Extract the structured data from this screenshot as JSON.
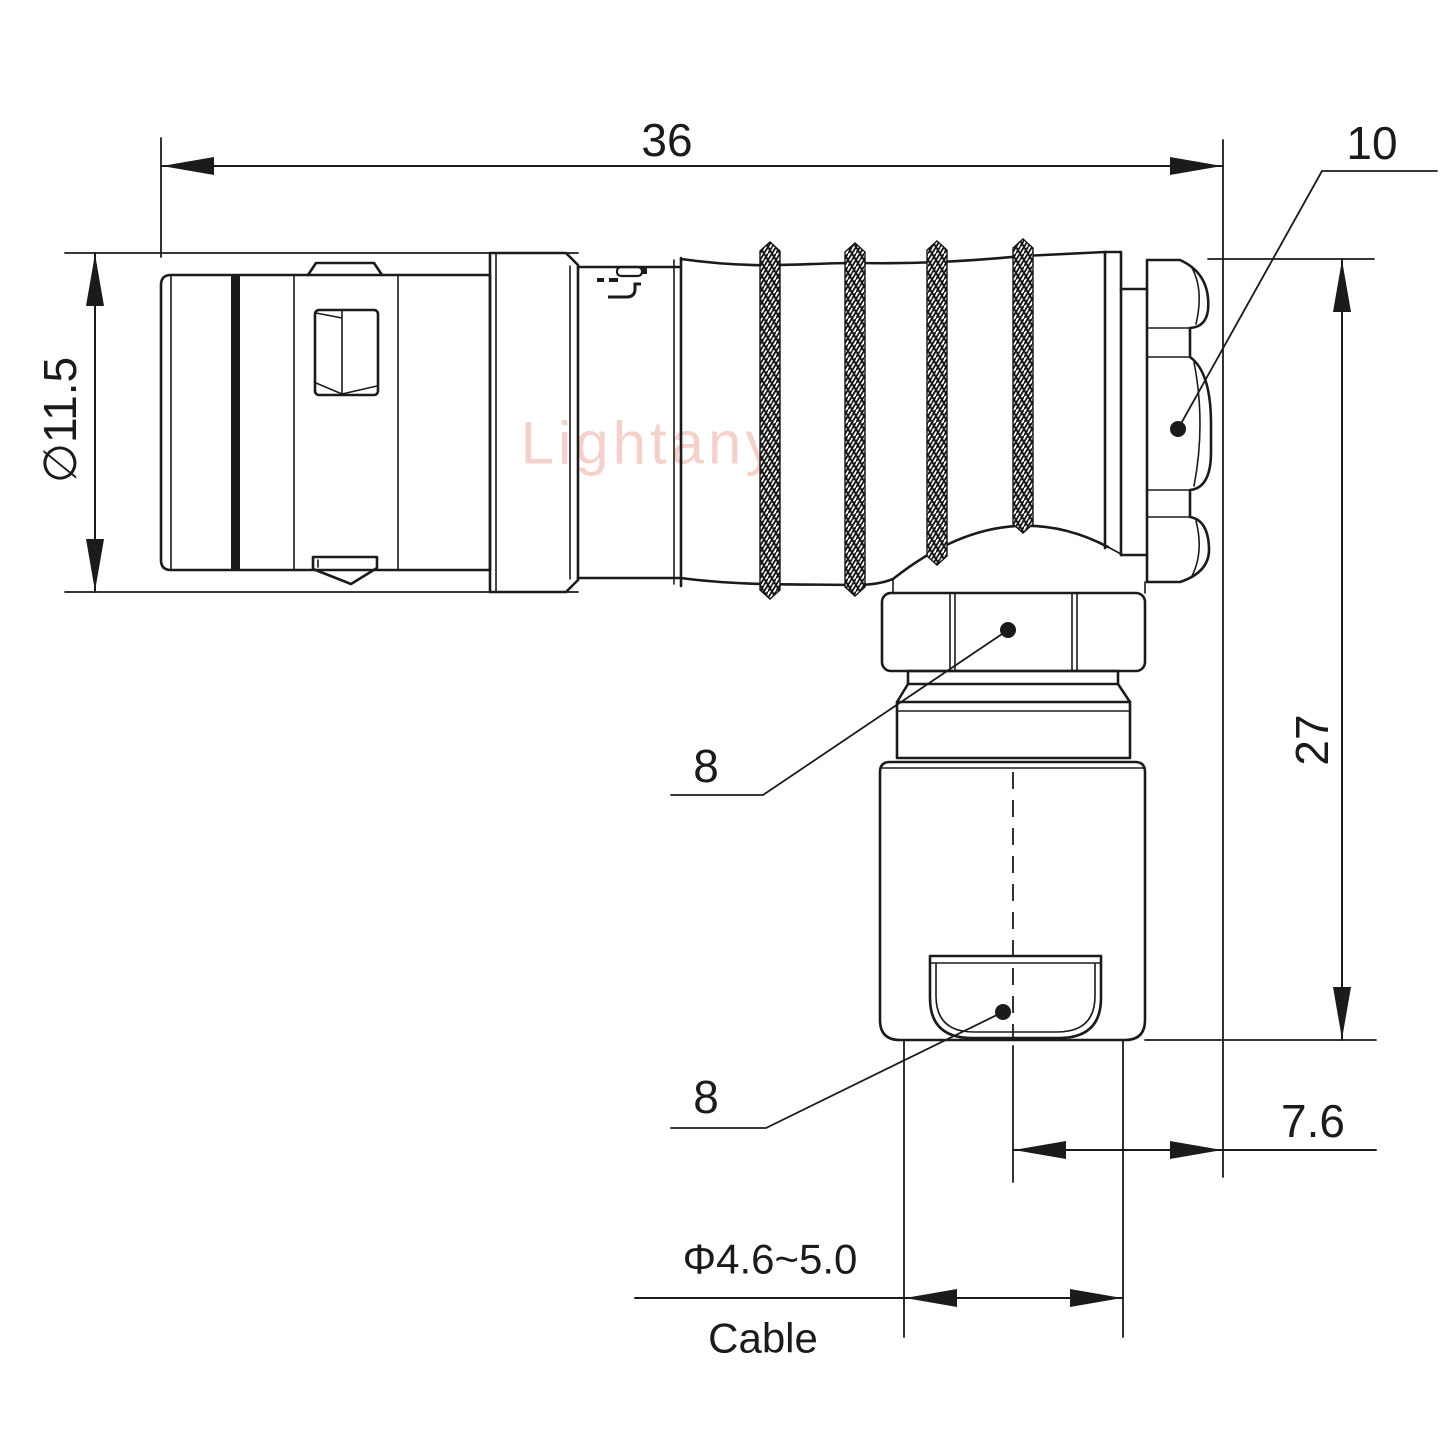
{
  "drawing": {
    "watermark": "Lightany",
    "colors": {
      "line": "#1b1b1b",
      "watermark": "#edaca4"
    },
    "dimensions": {
      "overall_length": "36",
      "rear_nut": "10",
      "shell_diameter": "∅11.5",
      "overall_height": "27",
      "coupling_hex": "8",
      "cable_hex": "8",
      "axis_offset": "7.6",
      "cable_range": "Φ4.6~5.0",
      "cable_word": "Cable"
    }
  }
}
